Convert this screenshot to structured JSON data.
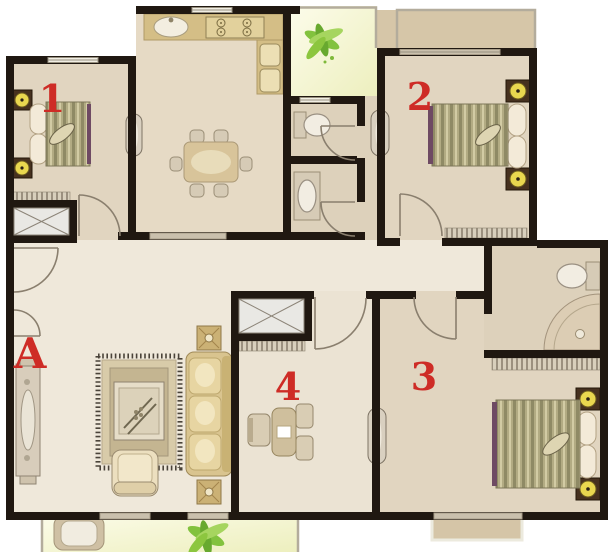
{
  "figure": {
    "type": "floor-plan",
    "description": "apartment floor plan, top-down view"
  },
  "rooms": [
    {
      "label": "1",
      "name": "bedroom-1"
    },
    {
      "label": "2",
      "name": "bedroom-2"
    },
    {
      "label": "3",
      "name": "bedroom-3"
    },
    {
      "label": "4",
      "name": "study-room"
    },
    {
      "label": "A",
      "name": "living-room"
    }
  ],
  "furniture": [
    "double-bed",
    "nightstand",
    "wardrobe",
    "closet-x",
    "dining-table",
    "dining-chair",
    "kitchen-counter",
    "kitchen-sink",
    "stove",
    "appliance",
    "toilet",
    "wash-basin",
    "corner-shower",
    "tv-cabinet",
    "rug",
    "coffee-table",
    "sofa",
    "armchair",
    "side-table",
    "desk",
    "desk-chair",
    "plant",
    "laundry-sink",
    "radiator-column"
  ],
  "colors": {
    "wall": "#201811",
    "accent": "#ce2c26",
    "floor-bedroom": "#e1d5c0",
    "floor-living": "#efe8da",
    "floor-kitchen": "#e6dac5",
    "floor-bath": "#ddd1bb",
    "floor-room4": "#ebe3d3",
    "bump": "#d6c6a8",
    "wood": "#d4be86",
    "gold": "#e9d74f",
    "purple": "#6e4a63",
    "green": "#7fbf3c"
  }
}
